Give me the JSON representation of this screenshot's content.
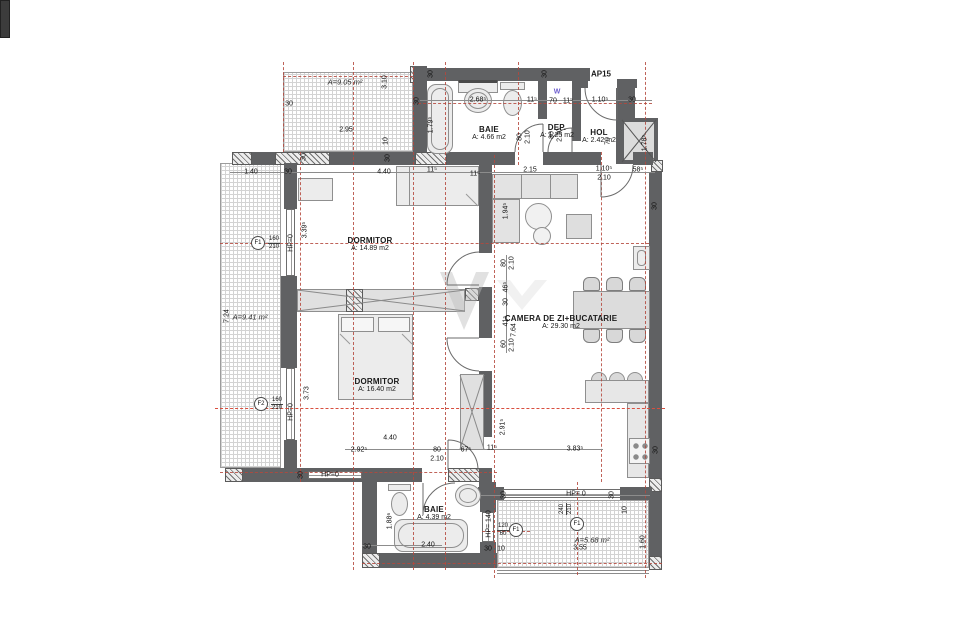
{
  "title": "AP15",
  "rooms": [
    {
      "name": "BAIE",
      "area": "A: 4.66 m2"
    },
    {
      "name": "DEP.",
      "area": "A: 1.25 m2"
    },
    {
      "name": "HOL",
      "area": "A: 2.42 m2"
    },
    {
      "name": "DORMITOR",
      "area": "A: 14.89 m2"
    },
    {
      "name": "DORMITOR",
      "area": "A: 16.40 m2"
    },
    {
      "name": "CAMERA DE ZI+BUCATARIE",
      "area": "A: 29.30 m2"
    },
    {
      "name": "BAIE",
      "area": "A: 4.39 m2"
    }
  ],
  "terraces": [
    {
      "label": "A=9.05 m²"
    },
    {
      "label": "A=9.41 m²"
    },
    {
      "label": "A=5.68 m²"
    }
  ],
  "colors": {
    "wall": "#606163",
    "axis": "#b5483d",
    "axis_strong": "#d94f3f",
    "annotation": "#111111",
    "w_label": "#6a5acd"
  },
  "annotations": {
    "window_markers": [
      {
        "id": "F1",
        "num": "160",
        "den": "210",
        "cx": 258,
        "cy": 243,
        "tx": 274,
        "ty": 243,
        "rot": 0
      },
      {
        "id": "F2",
        "num": "160",
        "den": "210",
        "cx": 261,
        "cy": 404,
        "tx": 277,
        "ty": 404,
        "rot": 0
      },
      {
        "id": "F1",
        "num": "120",
        "den": "60",
        "cx": 516,
        "cy": 530,
        "tx": 503,
        "ty": 530,
        "rot": 0
      },
      {
        "id": "F1",
        "num": "240",
        "den": "210",
        "cx": 577,
        "cy": 524,
        "tx": 566,
        "ty": 509,
        "rot": -90
      }
    ],
    "dimensions": [
      {
        "t": "2.95",
        "x": 346,
        "y": 130
      },
      {
        "t": "3.10",
        "x": 385,
        "y": 82,
        "r": -90
      },
      {
        "t": "10",
        "x": 386,
        "y": 141,
        "r": -90
      },
      {
        "t": "30",
        "x": 289,
        "y": 104
      },
      {
        "t": "30",
        "x": 417,
        "y": 101,
        "r": -90
      },
      {
        "t": "30",
        "x": 431,
        "y": 74,
        "r": -90
      },
      {
        "t": "30",
        "x": 545,
        "y": 74,
        "r": -90
      },
      {
        "t": "2.68⁵",
        "x": 478,
        "y": 100
      },
      {
        "t": "11⁵",
        "x": 532,
        "y": 100
      },
      {
        "t": "W",
        "x": 557,
        "y": 92,
        "c": "w"
      },
      {
        "t": "70",
        "x": 553,
        "y": 101
      },
      {
        "t": "11⁵",
        "x": 568,
        "y": 101
      },
      {
        "t": "1.10⁵",
        "x": 600,
        "y": 100
      },
      {
        "t": "30",
        "x": 632,
        "y": 100
      },
      {
        "t": "1.79⁵",
        "x": 431,
        "y": 125,
        "r": -90
      },
      {
        "t": "80",
        "x": 520,
        "y": 137,
        "r": -90
      },
      {
        "t": "2.10",
        "x": 528,
        "y": 137,
        "r": -90
      },
      {
        "t": "80",
        "x": 552,
        "y": 135,
        "r": -90
      },
      {
        "t": "2.10",
        "x": 560,
        "y": 135,
        "r": -90
      },
      {
        "t": "70",
        "x": 608,
        "y": 141,
        "r": -90
      },
      {
        "t": "1.78⁵",
        "x": 645,
        "y": 143,
        "r": -90
      },
      {
        "t": "1.40",
        "x": 251,
        "y": 172
      },
      {
        "t": "30",
        "x": 288,
        "y": 172
      },
      {
        "t": "4.40",
        "x": 384,
        "y": 172
      },
      {
        "t": "11⁵",
        "x": 432,
        "y": 170
      },
      {
        "t": "11⁵",
        "x": 475,
        "y": 174
      },
      {
        "t": "2.15",
        "x": 530,
        "y": 170
      },
      {
        "t": "1.10⁵",
        "x": 604,
        "y": 169
      },
      {
        "t": "2.10",
        "x": 604,
        "y": 178
      },
      {
        "t": "58⁵",
        "x": 638,
        "y": 170
      },
      {
        "t": "30",
        "x": 655,
        "y": 206,
        "r": -90
      },
      {
        "t": "30",
        "x": 304,
        "y": 157,
        "r": -90
      },
      {
        "t": "30",
        "x": 388,
        "y": 158,
        "r": -90
      },
      {
        "t": "7.24",
        "x": 227,
        "y": 316,
        "r": -90
      },
      {
        "t": "3.39⁵",
        "x": 305,
        "y": 230,
        "r": -90
      },
      {
        "t": "HP=0",
        "x": 291,
        "y": 243,
        "r": -90
      },
      {
        "t": "3.73",
        "x": 307,
        "y": 393,
        "r": -90
      },
      {
        "t": "HP=0",
        "x": 291,
        "y": 412,
        "r": -90
      },
      {
        "t": "1.94⁵",
        "x": 506,
        "y": 211,
        "r": -90
      },
      {
        "t": "80",
        "x": 504,
        "y": 263,
        "r": -90
      },
      {
        "t": "2.10",
        "x": 512,
        "y": 263,
        "r": -90
      },
      {
        "t": "46⁵",
        "x": 506,
        "y": 287,
        "r": -90
      },
      {
        "t": "30",
        "x": 506,
        "y": 302,
        "r": -90
      },
      {
        "t": "41⁵",
        "x": 506,
        "y": 321,
        "r": -90
      },
      {
        "t": "7.64",
        "x": 514,
        "y": 330,
        "r": -90
      },
      {
        "t": "60",
        "x": 504,
        "y": 344,
        "r": -90
      },
      {
        "t": "2.10",
        "x": 512,
        "y": 345,
        "r": -90
      },
      {
        "t": "2.91⁵",
        "x": 503,
        "y": 427,
        "r": -90
      },
      {
        "t": "4.40",
        "x": 390,
        "y": 438
      },
      {
        "t": "2.92⁵",
        "x": 359,
        "y": 450
      },
      {
        "t": "80",
        "x": 437,
        "y": 450
      },
      {
        "t": "2.10",
        "x": 437,
        "y": 459
      },
      {
        "t": "67⁵",
        "x": 466,
        "y": 450
      },
      {
        "t": "11⁵",
        "x": 492,
        "y": 448
      },
      {
        "t": "3.83⁵",
        "x": 575,
        "y": 449
      },
      {
        "t": "30",
        "x": 656,
        "y": 450,
        "r": -90
      },
      {
        "t": "HP=0",
        "x": 330,
        "y": 475
      },
      {
        "t": "30",
        "x": 301,
        "y": 475,
        "r": -90
      },
      {
        "t": "1.88⁶",
        "x": 390,
        "y": 521,
        "r": -90
      },
      {
        "t": "2.40",
        "x": 428,
        "y": 545
      },
      {
        "t": "30",
        "x": 367,
        "y": 547
      },
      {
        "t": "30",
        "x": 488,
        "y": 549
      },
      {
        "t": "10",
        "x": 501,
        "y": 549
      },
      {
        "t": "HP= 140",
        "x": 489,
        "y": 524,
        "r": -90
      },
      {
        "t": "HP= 0",
        "x": 576,
        "y": 494
      },
      {
        "t": "30",
        "x": 504,
        "y": 495,
        "r": -90
      },
      {
        "t": "30",
        "x": 612,
        "y": 495,
        "r": -90
      },
      {
        "t": "3.55",
        "x": 580,
        "y": 548
      },
      {
        "t": "1.60",
        "x": 643,
        "y": 542,
        "r": -90
      },
      {
        "t": "10",
        "x": 625,
        "y": 510,
        "r": -90
      }
    ]
  }
}
